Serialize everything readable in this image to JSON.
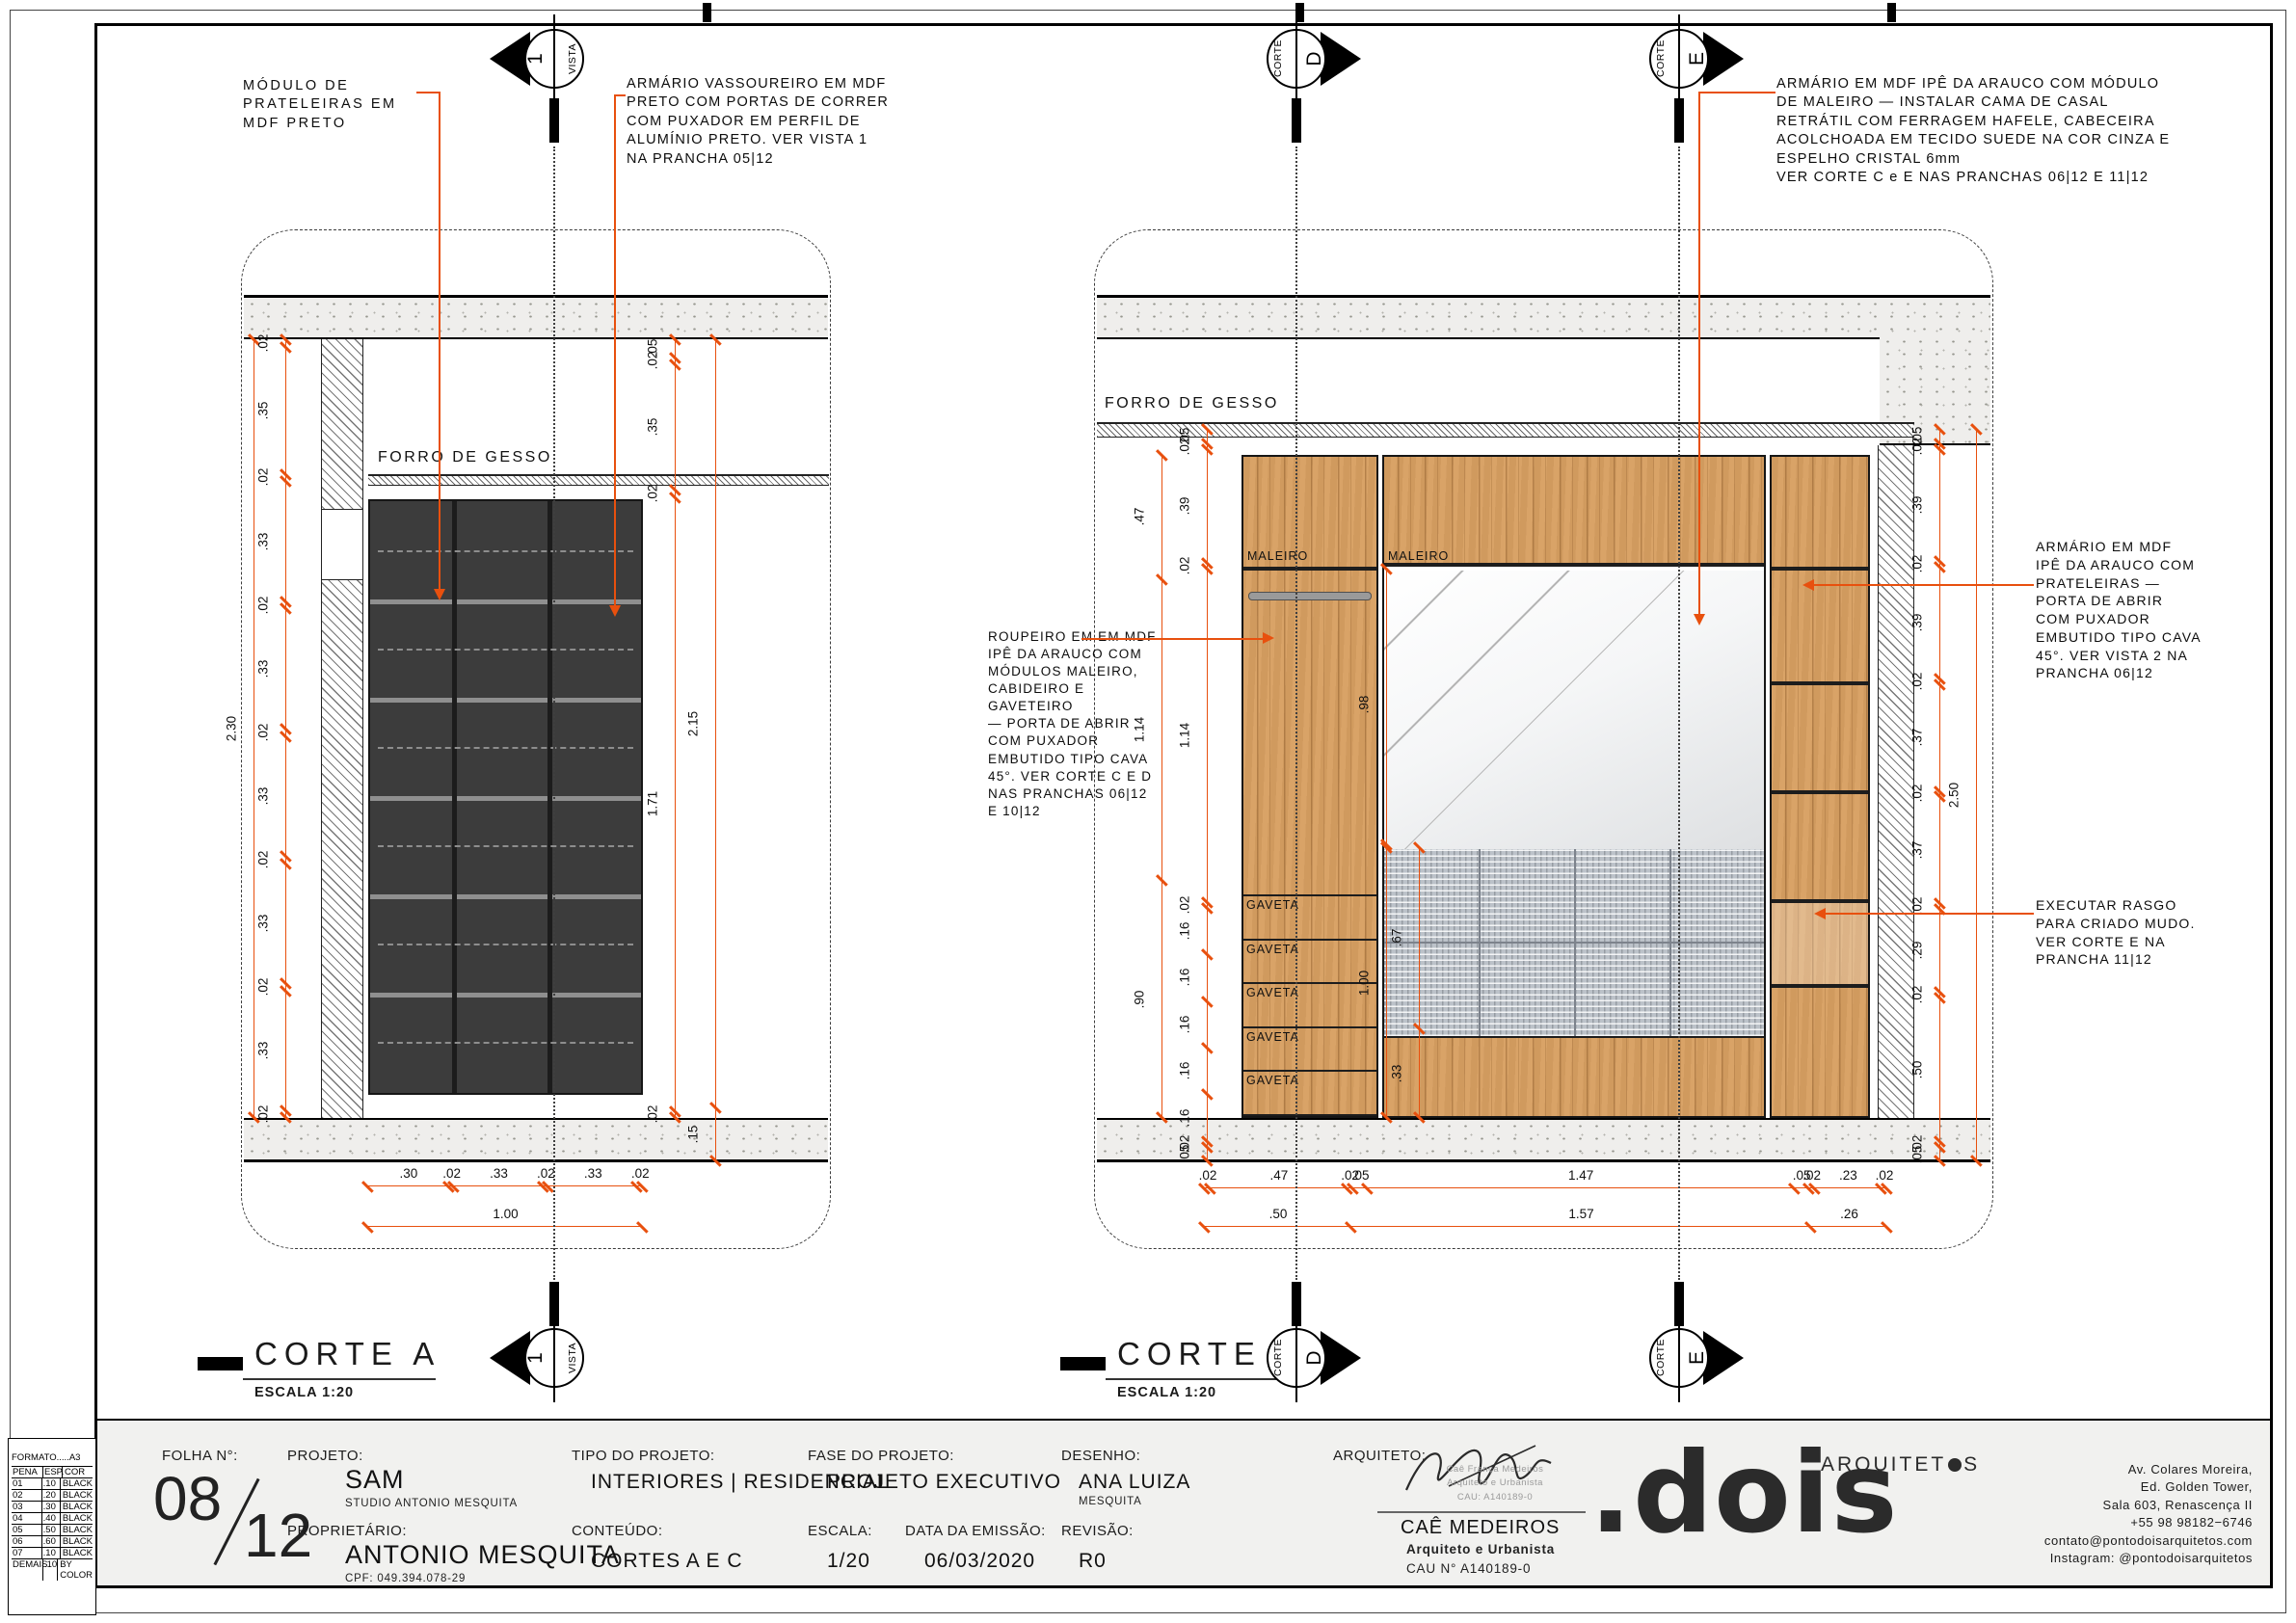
{
  "colors": {
    "dim_orange": "#e8500e",
    "wood": "#d9a367",
    "dark_mdf": "#3c3c3c",
    "headboard_grey": "#bcc2c9",
    "strip_bg": "#f1f1ef"
  },
  "annotations": {
    "modulo": "MÓDULO DE\nPRATELEIRAS EM\nMDF PRETO",
    "vassoureiro": "ARMÁRIO VASSOUREIRO EM MDF\nPRETO COM PORTAS DE CORRER\nCOM PUXADOR EM PERFIL DE\nALUMÍNIO PRETO. VER VISTA 1\nNA PRANCHA 05|12",
    "armario_top": "ARMÁRIO EM MDF IPÊ DA ARAUCO COM MÓDULO\nDE MALEIRO — INSTALAR CAMA DE CASAL\nRETRÁTIL COM FERRAGEM HAFELE, CABECEIRA\nACOLCHOADA EM TECIDO SUEDE NA COR CINZA E\nESPELHO CRISTAL 6mm\nVER CORTE C e E NAS PRANCHAS 06|12 E 11|12",
    "roupeiro": "ROUPEIRO EM EM MDF\nIPÊ DA ARAUCO COM\nMÓDULOS MALEIRO,\nCABIDEIRO E GAVETEIRO\n— PORTA DE ABRIR\nCOM PUXADOR\nEMBUTIDO TIPO CAVA\n45°. VER CORTE C E D\nNAS PRANCHAS 06|12\nE 10|12",
    "armario_right": "ARMÁRIO EM MDF\nIPÊ DA ARAUCO COM\nPRATELEIRAS —\nPORTA DE ABRIR\nCOM PUXADOR\nEMBUTIDO TIPO CAVA\n45°. VER VISTA 2 NA\nPRANCHA 06|12",
    "rasgo": "EXECUTAR RASGO\nPARA CRIADO MUDO.\nVER CORTE E NA\nPRANCHA 11|12"
  },
  "drawing_a": {
    "forro": "FORRO DE GESSO",
    "title": "CORTE A",
    "escala": "ESCALA 1:20"
  },
  "drawing_c": {
    "forro": "FORRO DE GESSO",
    "title": "CORTE C",
    "escala": "ESCALA 1:20",
    "maleiro_left": "MALEIRO",
    "maleiro_center": "MALEIRO",
    "gavetas": [
      "GAVETA",
      "GAVETA",
      "GAVETA",
      "GAVETA",
      "GAVETA"
    ]
  },
  "markers": {
    "vista": {
      "num": "1",
      "word": "VISTA"
    },
    "d": {
      "word": "CORTE",
      "letter": "D"
    },
    "e": {
      "word": "CORTE",
      "letter": "E"
    }
  },
  "dim_chains": {
    "a_left_overall": [
      "2.30"
    ],
    "a_left": [
      ".02",
      ".35",
      ".02",
      ".33",
      ".02",
      ".33",
      ".02",
      ".33",
      ".02",
      ".33",
      ".02",
      ".33",
      ".02"
    ],
    "a_right_inner": [
      ".05",
      ".02",
      ".35",
      ".02",
      "1.71",
      ".02"
    ],
    "a_right_outer": [
      "2.15",
      ".15"
    ],
    "a_bottom_segs": [
      ".30",
      ".02",
      ".33",
      ".02",
      ".33",
      ".02"
    ],
    "a_bottom_total": [
      "1.00"
    ],
    "c_left_outer": [
      ".47",
      "1.14",
      ".90"
    ],
    "c_left_inner": [
      ".05",
      ".02",
      ".39",
      ".02",
      "1.14",
      ".02",
      ".16",
      ".16",
      ".16",
      ".16",
      ".16",
      ".02",
      ".05"
    ],
    "c_mirror": [
      ".98"
    ],
    "c_head_total": [
      "1.00"
    ],
    "c_head_segs": [
      ".67",
      ".33"
    ],
    "c_right_inner": [
      ".05",
      ".02",
      ".39",
      ".02",
      ".39",
      ".02",
      ".37",
      ".02",
      ".37",
      ".02",
      ".29",
      ".02",
      ".50",
      ".02",
      ".05"
    ],
    "c_right_outer": [
      "2.50"
    ],
    "c_bottom_segs": [
      ".02",
      ".47",
      ".02",
      ".05",
      "1.47",
      ".05",
      ".02",
      ".23",
      ".02"
    ],
    "c_bottom_total": [
      ".50",
      "1.57",
      ".26"
    ]
  },
  "titleblock": {
    "folha_label": "FOLHA N°:",
    "folha_num": "08",
    "folha_den": "12",
    "projeto_label": "PROJETO:",
    "projeto": "SAM",
    "projeto_sub": "STUDIO ANTONIO MESQUITA",
    "prop_label": "PROPRIETÁRIO:",
    "prop": "ANTONIO MESQUITA",
    "prop_sub": "CPF: 049.394.078-29",
    "tipo_label": "TIPO DO PROJETO:",
    "tipo": "INTERIORES | RESIDENCIAL",
    "conteudo_label": "CONTEÚDO:",
    "conteudo": "CORTES A E C",
    "fase_label": "FASE DO PROJETO:",
    "fase": "PROJETO EXECUTIVO",
    "escala_label": "ESCALA:",
    "escala": "1/20",
    "data_label": "DATA DA EMISSÃO:",
    "data": "06/03/2020",
    "desenho_label": "DESENHO:",
    "desenho": "ANA LUIZA",
    "desenho_sub": "MESQUITA",
    "revisao_label": "REVISÃO:",
    "revisao": "R0",
    "arquiteto_label": "ARQUITETO:",
    "arquiteto": {
      "stamp_lines": [
        "Caê França Medeiros",
        "Arquiteto e Urbanista",
        "CAU: A140189-0"
      ],
      "nome": "CAÊ MEDEIROS",
      "cargo": "Arquiteto e Urbanista",
      "cau": "CAU N° A140189-0"
    },
    "logo": {
      "top": "ARQUITET",
      "top_s": "S",
      "main": ".dois"
    },
    "address_lines": [
      "Av. Colares Moreira,",
      "Ed. Golden Tower,",
      "Sala 603, Renascença II",
      "+55 98 98182−6746",
      "contato@pontodoisarquitetos.com",
      "Instagram: @pontodoisarquitetos"
    ],
    "pen_table": {
      "formato": "FORMATO.....A3",
      "headers": [
        "PENA",
        "ESP.",
        "COR"
      ],
      "rows": [
        [
          "01",
          ".10",
          "BLACK"
        ],
        [
          "02",
          ".20",
          "BLACK"
        ],
        [
          "03",
          ".30",
          "BLACK"
        ],
        [
          "04",
          ".40",
          "BLACK"
        ],
        [
          "05",
          ".50",
          "BLACK"
        ],
        [
          "06",
          ".60",
          "BLACK"
        ],
        [
          "07",
          ".10",
          "BLACK"
        ],
        [
          "DEMAIS",
          ".10",
          "BY COLOR"
        ]
      ]
    }
  }
}
